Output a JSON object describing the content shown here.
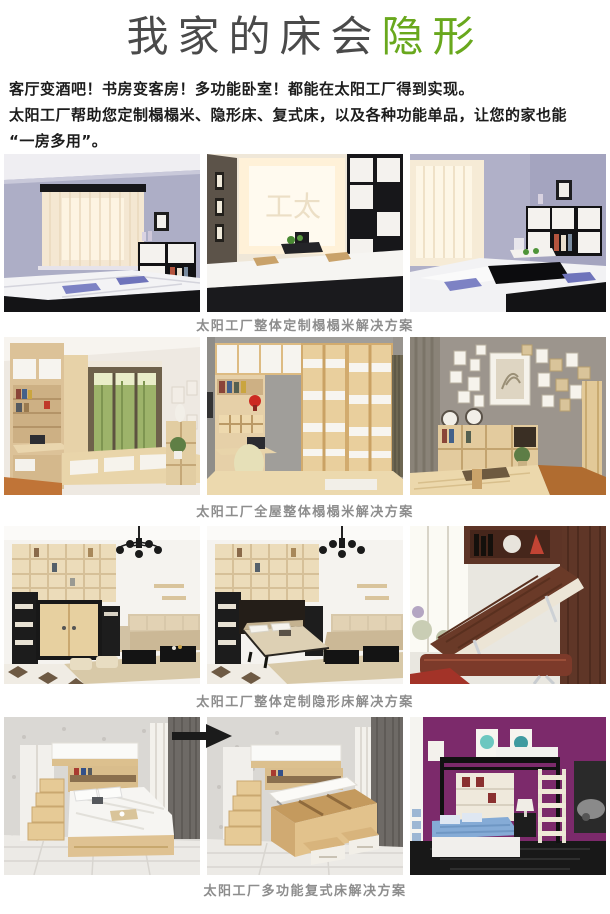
{
  "title": {
    "prefix": "我家的床会",
    "highlight": "隐形"
  },
  "intro": {
    "line1": "客厅变酒吧！书房变客房！多功能卧室！都能在太阳工厂得到实现。",
    "line2": "太阳工厂帮助您定制榻榻米、隐形床、复式床，以及各种功能单品，让您的家也能",
    "line3": "“一房多用”。"
  },
  "watermark": "工太",
  "colors": {
    "accent_green": "#69a81d",
    "caption_gray": "#8d8d8d"
  },
  "sections": [
    {
      "caption": "太阳工厂整体定制榻榻米解决方案",
      "photos": [
        {
          "alt": "黑白榻榻米卧室"
        },
        {
          "alt": "榻榻米茶台明窗"
        },
        {
          "alt": "榻榻米升降台收纳柜"
        }
      ]
    },
    {
      "caption": "太阳工厂全屋整体榻榻米解决方案",
      "photos": [
        {
          "alt": "原木书房飘窗"
        },
        {
          "alt": "原木衣柜书桌"
        },
        {
          "alt": "照片墙榻榻米房"
        }
      ]
    },
    {
      "caption": "太阳工厂整体定制隐形床解决方案",
      "photos": [
        {
          "alt": "隐形床收起客厅"
        },
        {
          "alt": "隐形床展开客厅"
        },
        {
          "alt": "深色翻板隐形床"
        }
      ]
    },
    {
      "caption": "太阳工厂多功能复式床解决方案",
      "photos": [
        {
          "alt": "复式床楼梯收纳"
        },
        {
          "alt": "复式床箱体掀开"
        },
        {
          "alt": "黑色高架复式床"
        }
      ]
    }
  ]
}
